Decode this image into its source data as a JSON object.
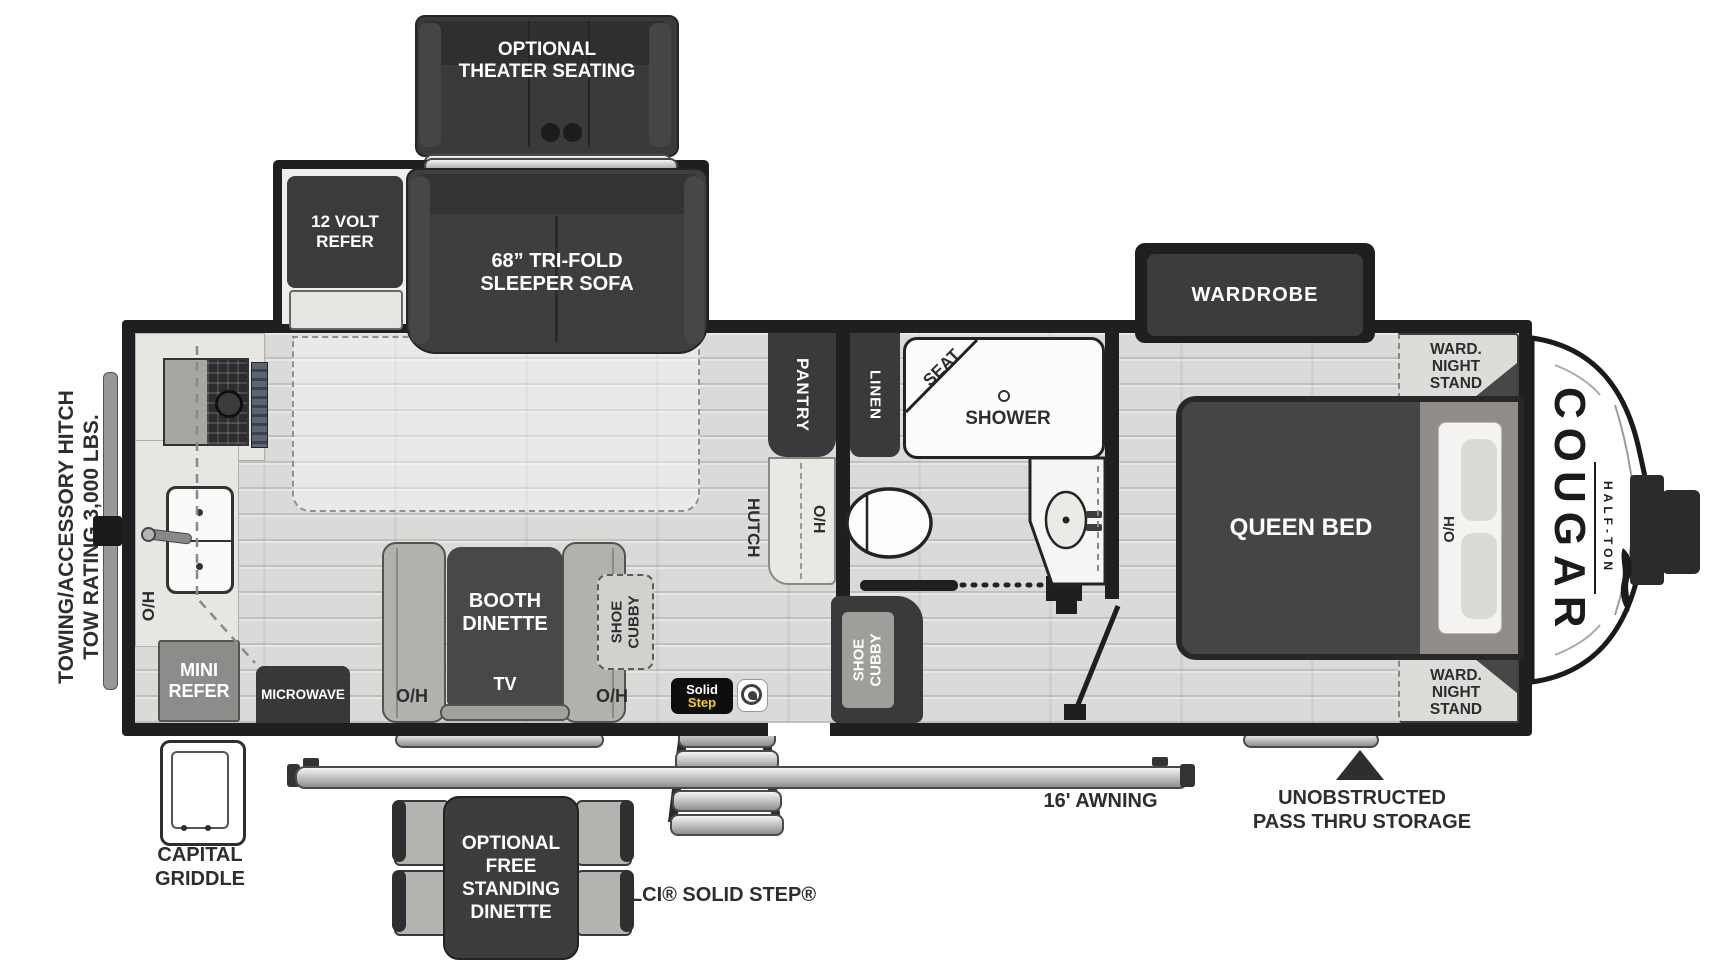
{
  "exterior": {
    "towing_line1": "TOWING/ACCESSORY HITCH",
    "towing_line2": "TOW RATING 3,000 LBS.",
    "theater_line1": "OPTIONAL",
    "theater_line2": "THEATER SEATING",
    "capital_griddle_line1": "CAPITAL",
    "capital_griddle_line2": "GRIDDLE",
    "free_dinette_line1": "OPTIONAL",
    "free_dinette_line2": "FREE",
    "free_dinette_line3": "STANDING",
    "free_dinette_line4": "DINETTE",
    "solid_step_label": "LCI® SOLID STEP®",
    "badge_solid": "Solid",
    "badge_step": "Step",
    "awning_label": "16' AWNING",
    "passthru_line1": "UNOBSTRUCTED",
    "passthru_line2": "PASS THRU STORAGE"
  },
  "living": {
    "refer_line1": "12 VOLT",
    "refer_line2": "REFER",
    "sofa_line1": "68” TRI-FOLD",
    "sofa_line2": "SLEEPER SOFA",
    "pantry": "PANTRY",
    "hutch": "HUTCH",
    "oh": "O/H",
    "booth_line1": "BOOTH",
    "booth_line2": "DINETTE",
    "tv": "TV",
    "shoe_cubby_line1": "SHOE",
    "shoe_cubby_line2": "CUBBY",
    "microwave": "MICROWAVE",
    "mini_refer_line1": "MINI",
    "mini_refer_line2": "REFER"
  },
  "bath": {
    "linen": "LINEN",
    "seat": "SEAT",
    "shower": "SHOWER",
    "shoe_cubby_line1": "SHOE",
    "shoe_cubby_line2": "CUBBY"
  },
  "bedroom": {
    "wardrobe": "WARDROBE",
    "queen_bed": "QUEEN BED",
    "oh": "O/H",
    "nightstand_line1": "WARD.",
    "nightstand_line2": "NIGHT",
    "nightstand_line3": "STAND"
  },
  "branding": {
    "model": "COUGAR",
    "series": "HALF-TON"
  },
  "colors": {
    "wall": "#1f1f21",
    "dark_furniture": "#3b3b3d",
    "floor": "#dcdad8",
    "accent_yellow": "#f5d400"
  }
}
